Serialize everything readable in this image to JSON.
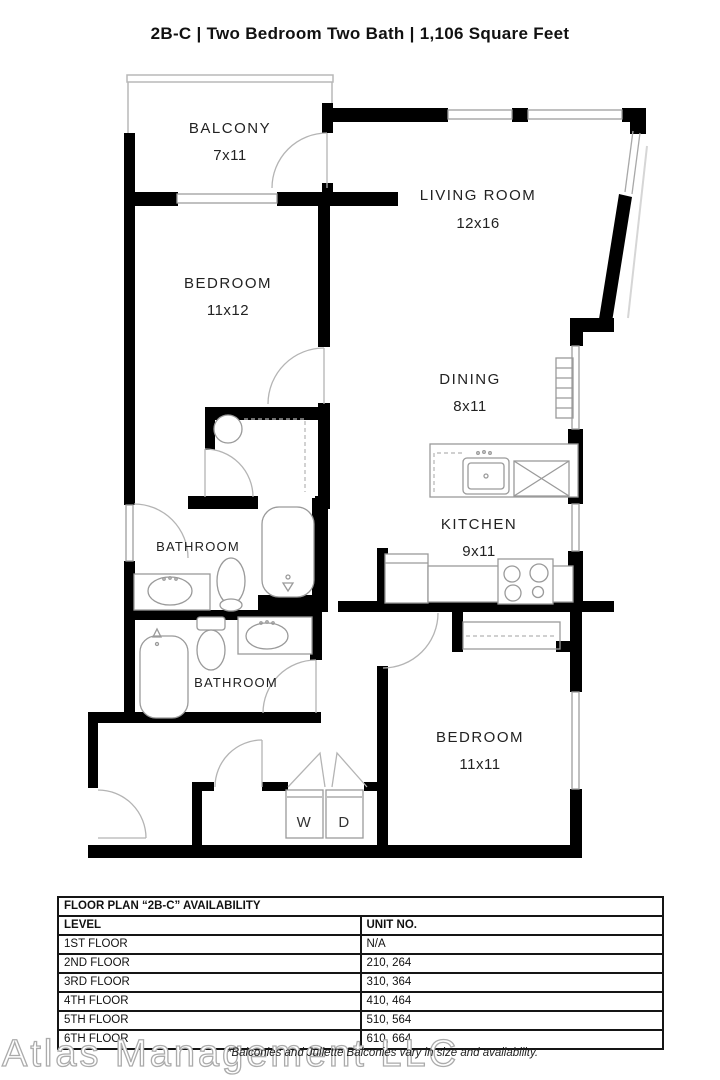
{
  "title": "2B-C | Two Bedroom Two Bath | 1,106 Square Feet",
  "rooms": {
    "balcony": {
      "name": "BALCONY",
      "dims": "7x11"
    },
    "living_room": {
      "name": "LIVING ROOM",
      "dims": "12x16"
    },
    "bedroom_1": {
      "name": "BEDROOM",
      "dims": "11x12"
    },
    "dining": {
      "name": "DINING",
      "dims": "8x11"
    },
    "kitchen": {
      "name": "KITCHEN",
      "dims": "9x11"
    },
    "bathroom_1": {
      "name": "BATHROOM"
    },
    "bathroom_2": {
      "name": "BATHROOM"
    },
    "bedroom_2": {
      "name": "BEDROOM",
      "dims": "11x11"
    },
    "washer_label": "W",
    "dryer_label": "D"
  },
  "availability_table": {
    "title": "FLOOR PLAN “2B-C” AVAILABILITY",
    "columns": {
      "level": "LEVEL",
      "unit": "UNIT NO."
    },
    "rows": [
      {
        "level": "1ST FLOOR",
        "unit": "N/A"
      },
      {
        "level": "2ND FLOOR",
        "unit": "210, 264"
      },
      {
        "level": "3RD FLOOR",
        "unit": "310, 364"
      },
      {
        "level": "4TH FLOOR",
        "unit": "410, 464"
      },
      {
        "level": "5TH FLOOR",
        "unit": "510, 564"
      },
      {
        "level": "6TH FLOOR",
        "unit": "610, 664"
      }
    ]
  },
  "footer": {
    "watermark": "Atlas Management LLC",
    "note": "*Balconies and Juliette Balconies vary in size and availability."
  },
  "colors": {
    "wall": "#000000",
    "window": "#9f9f9f",
    "fixture": "#9a9a9a",
    "accent_text": "#222222"
  }
}
